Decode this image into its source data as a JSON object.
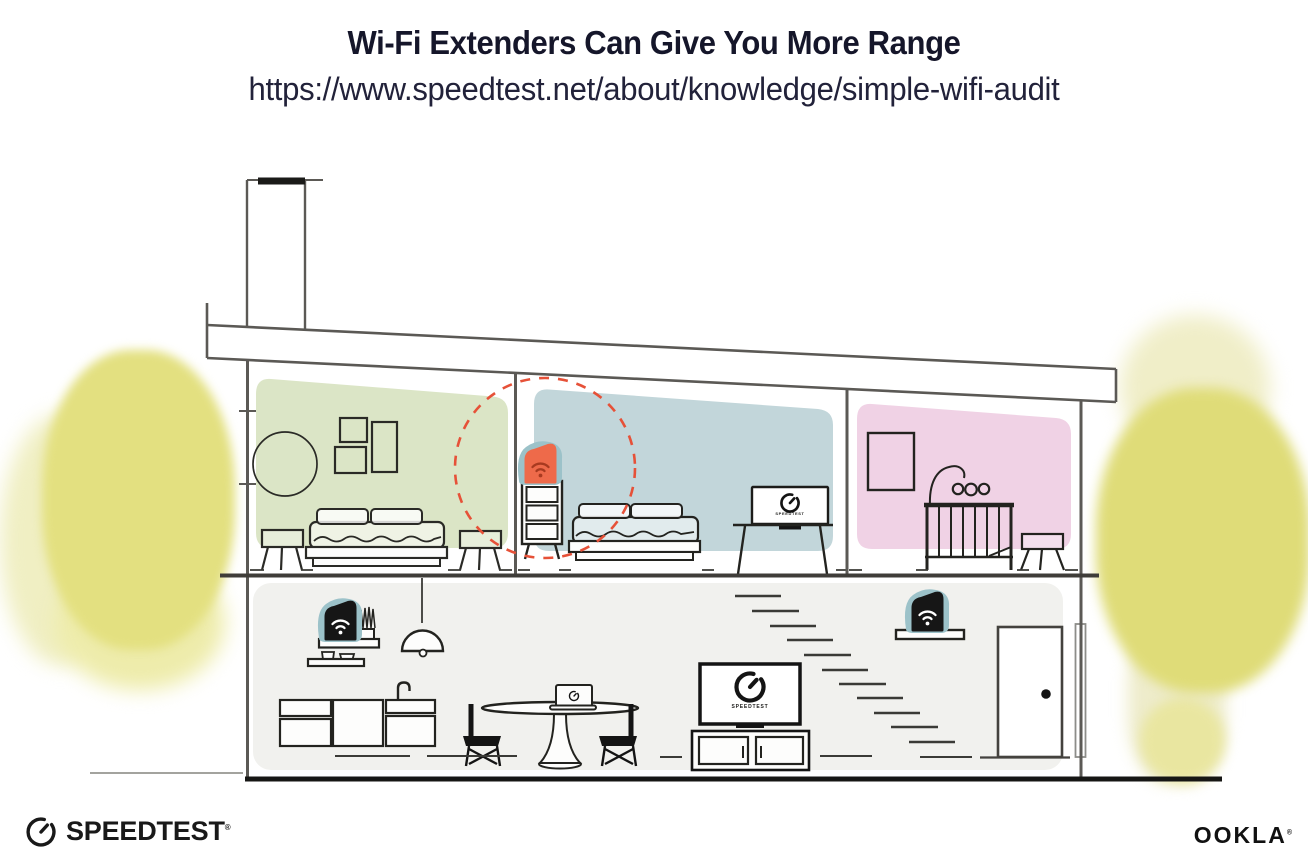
{
  "header": {
    "title": "Wi-Fi Extenders Can Give You More Range",
    "url": "https://www.speedtest.net/about/knowledge/simple-wifi-audit"
  },
  "footer": {
    "speedtest_label": "SPEEDTEST",
    "speedtest_trademark": "®",
    "ookla_label": "OOKLA",
    "ookla_trademark": "®"
  },
  "illustration": {
    "bedroom_tv_label": "SPEEDTEST",
    "living_tv_label": "SPEEDTEST",
    "devices": [
      {
        "name": "wifi-extender-icon",
        "location": "upstairs dresser",
        "color": "#ee6a4a"
      },
      {
        "name": "wifi-router-icon",
        "location": "living room left shelf",
        "color": "#161616"
      },
      {
        "name": "wifi-router-icon",
        "location": "living room right shelf",
        "color": "#161616"
      }
    ],
    "colors": {
      "range_circle_red": "#e65138",
      "extender_orange": "#ee6a4a",
      "device_backdrop_teal": "#9cc2c9",
      "bedroom_green": "#dbe5c6",
      "bedroom_blue": "#c2d6da",
      "nursery_pink": "#f0d2e5",
      "living_gray": "#f1f1ee",
      "foliage_yellow": "#e4e183"
    }
  }
}
